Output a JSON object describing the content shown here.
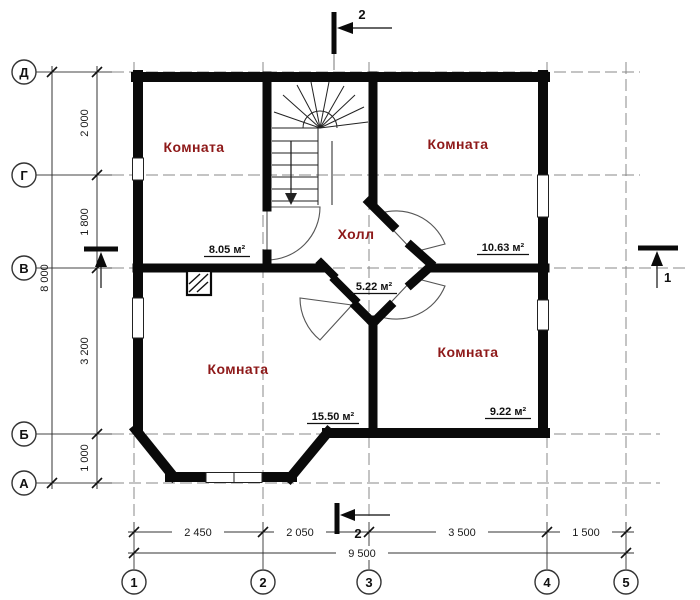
{
  "plan": {
    "rooms": [
      {
        "label": "Комната",
        "area": "8.05 м²"
      },
      {
        "label": "Комната",
        "area": "10.63 м²"
      },
      {
        "label": "Холл",
        "area": "5.22 м²"
      },
      {
        "label": "Комната",
        "area": "15.50 м²"
      },
      {
        "label": "Комната",
        "area": "9.22 м²"
      }
    ],
    "axes": {
      "rows": [
        "Д",
        "Г",
        "В",
        "Б",
        "А"
      ],
      "cols": [
        "1",
        "2",
        "3",
        "4",
        "5"
      ]
    },
    "dimensions": {
      "left_segments": [
        "2 000",
        "1 800",
        "3 200",
        "1 000"
      ],
      "left_total": "8 000",
      "bottom_segments": [
        "2 450",
        "2 050",
        "3 500",
        "1 500"
      ],
      "bottom_total": "9 500"
    },
    "sections": {
      "cut_2_top": "2",
      "cut_2_bottom": "2",
      "cut_1_right": "1"
    },
    "colors": {
      "walls": "#0a0a0a",
      "room_label": "#8e1919"
    }
  }
}
